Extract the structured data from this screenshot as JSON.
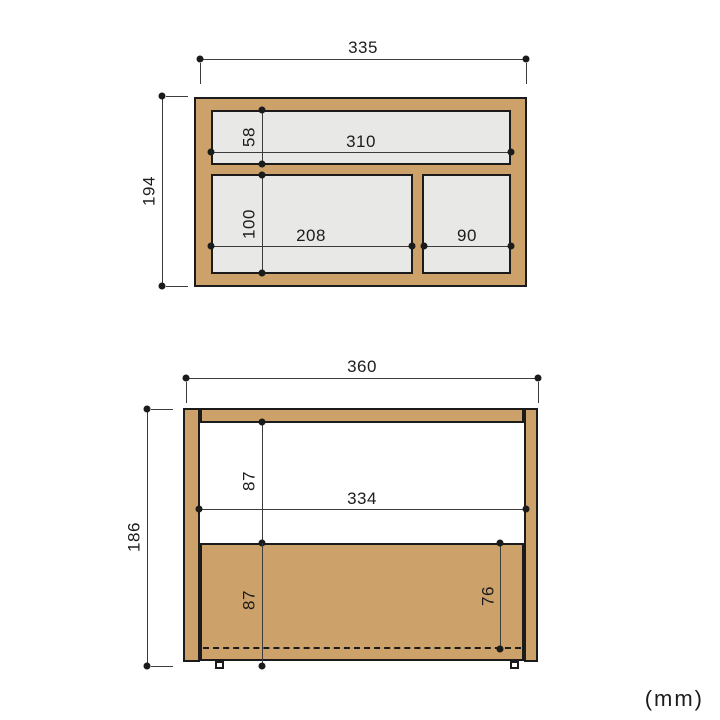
{
  "unit_label": "(mm)",
  "colors": {
    "wood": "#cda26a",
    "cavity": "#e8e8e6",
    "outline": "#1b1b1b",
    "dim": "#3c3c3c",
    "ink": "#1c1c1c",
    "bg": "#ffffff"
  },
  "top_view": {
    "dims": {
      "overall_width": "335",
      "overall_depth": "194",
      "inner_width": "310",
      "top_compartment_depth": "58",
      "bottom_compartment_depth": "100",
      "bottom_left_compartment_width": "208",
      "bottom_right_compartment_width": "90"
    }
  },
  "front_view": {
    "dims": {
      "overall_width": "360",
      "overall_height": "186",
      "inner_width": "334",
      "upper_opening_height": "87",
      "lower_section_height": "87",
      "right_section_height": "76"
    }
  }
}
